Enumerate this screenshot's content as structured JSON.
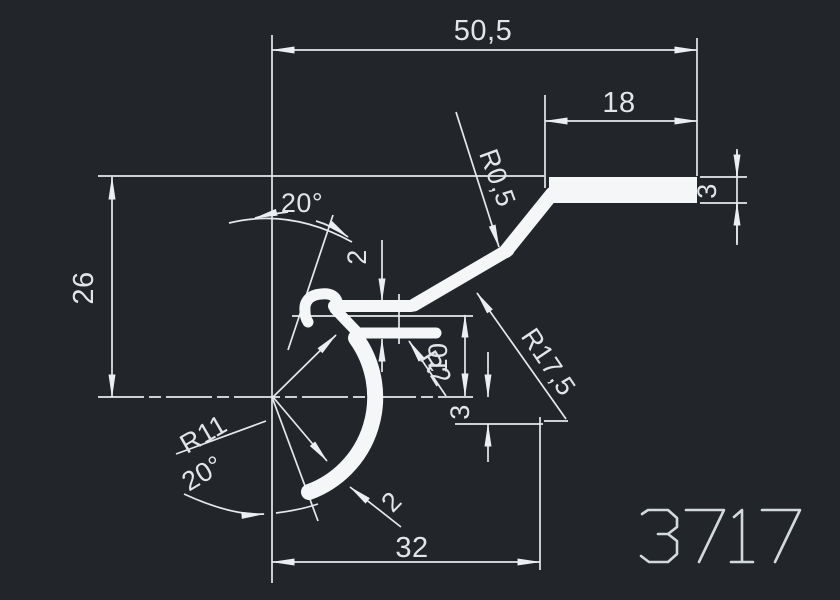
{
  "drawing": {
    "part_number": "3717",
    "background_color": "#22262b",
    "line_color": "#e6e9ec",
    "profile_color": "#f4f6f7",
    "text_color": "#e2e6e9",
    "dimensions": {
      "overall_width": "50,5",
      "top_flange_length": "18",
      "top_flange_thickness": "3",
      "height_to_center": "26",
      "angle_top": "20°",
      "slot_gap": "2",
      "bend_radius_small": "R0,5",
      "bend_radius_large": "R17,5",
      "fillet_radius": "R2",
      "step_height": "10",
      "step_offset": "3",
      "arc_radius": "R11",
      "angle_bottom": "20°",
      "wall_thickness": "2",
      "bottom_width": "32"
    }
  }
}
